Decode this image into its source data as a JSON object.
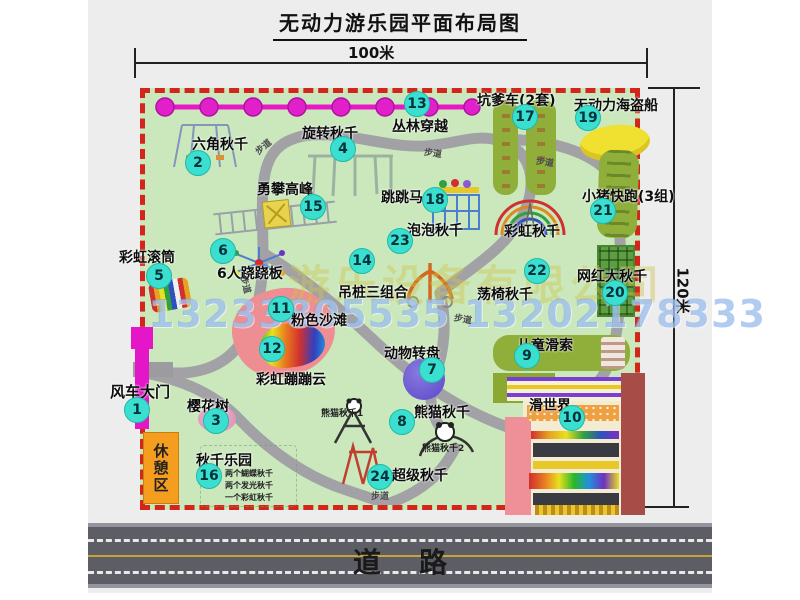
{
  "title": "无动力游乐园平面布局图",
  "dimensions": {
    "top": "100米",
    "right": "120米"
  },
  "road": {
    "label": "道路"
  },
  "rest_area": {
    "label": "休憩区"
  },
  "watermark": {
    "company": "游乐设备有限公司",
    "phones": "13233805535 13202178333"
  },
  "colors": {
    "map_green": "#cbe8bd",
    "border_red": "#d3261b",
    "badge_cyan": "#3adfd0",
    "gate_magenta": "#e515c8",
    "path_gray": "#a2a2a6",
    "road_gray": "#5d5d66",
    "road_yellow": "#c8a437",
    "rest_orange": "#f59d1e"
  },
  "attractions": [
    {
      "num": "1",
      "name": "风车大门",
      "bx": 49,
      "by": 410,
      "lx": 22,
      "ly": 381,
      "ls": 15
    },
    {
      "num": "2",
      "name": "六角秋千",
      "bx": 110,
      "by": 163,
      "lx": 104,
      "ly": 134
    },
    {
      "num": "3",
      "name": "樱花树",
      "bx": 128,
      "by": 421,
      "lx": 99,
      "ly": 396
    },
    {
      "num": "4",
      "name": "旋转秋千",
      "bx": 255,
      "by": 149,
      "lx": 214,
      "ly": 123
    },
    {
      "num": "5",
      "name": "彩虹滚筒",
      "bx": 71,
      "by": 276,
      "lx": 31,
      "ly": 247
    },
    {
      "num": "6",
      "name": "6人跷跷板",
      "bx": 135,
      "by": 251,
      "lx": 129,
      "ly": 263
    },
    {
      "num": "7",
      "name": "动物转盘",
      "bx": 344,
      "by": 370,
      "lx": 296,
      "ly": 343
    },
    {
      "num": "8",
      "name": "熊猫秋千",
      "bx": 314,
      "by": 422,
      "lx": 326,
      "ly": 402
    },
    {
      "num": "9",
      "name": "儿童滑索",
      "bx": 439,
      "by": 356,
      "lx": 429,
      "ly": 335
    },
    {
      "num": "10",
      "name": "滑世界",
      "bx": 484,
      "by": 418,
      "lx": 441,
      "ly": 395
    },
    {
      "num": "11",
      "name": "粉色沙滩",
      "bx": 193,
      "by": 309,
      "lx": 203,
      "ly": 310
    },
    {
      "num": "12",
      "name": "彩虹蹦蹦云",
      "bx": 184,
      "by": 349,
      "lx": 168,
      "ly": 369
    },
    {
      "num": "13",
      "name": "丛林穿越",
      "bx": 329,
      "by": 104,
      "lx": 304,
      "ly": 116
    },
    {
      "num": "14",
      "name": "吊桩三组合",
      "bx": 274,
      "by": 261,
      "lx": 250,
      "ly": 282
    },
    {
      "num": "15",
      "name": "勇攀高峰",
      "bx": 225,
      "by": 207,
      "lx": 169,
      "ly": 179
    },
    {
      "num": "16",
      "name": "秋千乐园",
      "bx": 121,
      "by": 476,
      "lx": 108,
      "ly": 450
    },
    {
      "num": "17",
      "name": "坑爹车(2套)",
      "bx": 437,
      "by": 117,
      "lx": 389,
      "ly": 90
    },
    {
      "num": "18",
      "name": "跳跳马",
      "bx": 347,
      "by": 200,
      "lx": 293,
      "ly": 187
    },
    {
      "num": "19",
      "name": "无动力海盗船",
      "bx": 500,
      "by": 118,
      "lx": 486,
      "ly": 95
    },
    {
      "num": "20",
      "name": "网红大秋千",
      "bx": 527,
      "by": 293,
      "lx": 489,
      "ly": 266
    },
    {
      "num": "21",
      "name": "小猪快跑(3组)",
      "bx": 515,
      "by": 211,
      "lx": 494,
      "ly": 186
    },
    {
      "num": "22",
      "name": "荡椅秋千",
      "bx": 449,
      "by": 271,
      "lx": 389,
      "ly": 284
    },
    {
      "num": "23",
      "name": "泡泡秋千",
      "bx": 312,
      "by": 241,
      "lx": 319,
      "ly": 220
    },
    {
      "num": "24",
      "name": "超级秋千",
      "bx": 292,
      "by": 477,
      "lx": 304,
      "ly": 465
    }
  ],
  "extra_labels": [
    {
      "text": "彩虹秋千",
      "x": 416,
      "y": 221,
      "size": 14
    },
    {
      "text": "熊猫秋千1",
      "x": 233,
      "y": 406,
      "size": 9
    },
    {
      "text": "熊猫秋千2",
      "x": 334,
      "y": 441,
      "size": 9
    },
    {
      "text": "两个蝴蝶秋千",
      "x": 137,
      "y": 468,
      "size": 8
    },
    {
      "text": "两个发光秋千",
      "x": 137,
      "y": 480,
      "size": 8
    },
    {
      "text": "一个彩虹秋千",
      "x": 137,
      "y": 492,
      "size": 8
    }
  ],
  "path_label_text": "步道",
  "path_labels": [
    {
      "x": 166,
      "y": 140,
      "rot": -40
    },
    {
      "x": 336,
      "y": 146,
      "rot": 8
    },
    {
      "x": 448,
      "y": 155,
      "rot": 8
    },
    {
      "x": 149,
      "y": 278,
      "rot": 75
    },
    {
      "x": 366,
      "y": 312,
      "rot": 10
    },
    {
      "x": 283,
      "y": 489,
      "rot": 0
    }
  ]
}
